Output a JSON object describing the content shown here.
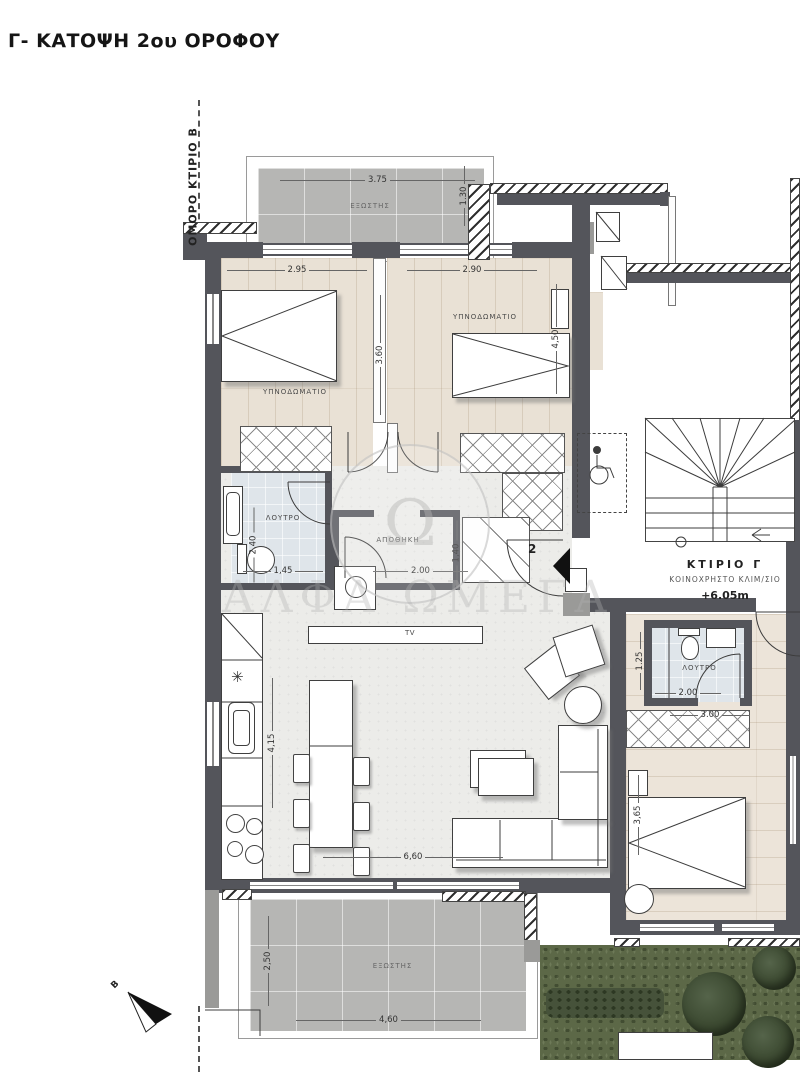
{
  "title": "Γ- ΚΑΤΟΨΗ 2ου ΟΡΟΦΟΥ",
  "neighbor_label": "ΟΜΟΡΟ ΚΤΙΡΙΟ Β",
  "north_label": "Β",
  "watermark": {
    "text": "ΑΛΦΑ ΩΜΕΓΑ",
    "monogram": "Ω"
  },
  "entry": {
    "door_number": "2"
  },
  "stairwell": {
    "building": "ΚΤΙΡΙΟ  Γ",
    "use": "ΚΟΙΝΟΧΡΗΣΤΟ ΚΛΙΜ/ΣΙΟ",
    "level": "+6.05m"
  },
  "rooms": {
    "balcony_top": {
      "label": "ΕΞΩΣΤΗΣ",
      "width": "3.75",
      "depth": "1.30"
    },
    "bedroom1": {
      "label": "ΥΠΝΟΔΩΜΑΤΙΟ",
      "width": "2.95",
      "depth": "3.60"
    },
    "bedroom2": {
      "label": "ΥΠΝΟΔΩΜΑΤΙΟ",
      "width": "2.90",
      "depth": "4,50"
    },
    "bathroom1": {
      "label": "ΛΟΥΤΡΟ",
      "width": "1,45",
      "depth": "2.40"
    },
    "storage": {
      "label": "ΑΠΟΘΗΚΗ",
      "width": "2.00",
      "closet_depth": "1,40"
    },
    "living": {
      "tv_label": "TV",
      "width": "6,60",
      "depth": "4,15"
    },
    "bathroom2": {
      "label": "ΛΟΥΤΡΟ",
      "width": "2.00",
      "depth": "1.25",
      "wardrobe_width": "3.00"
    },
    "bedroom3": {
      "depth": "3,65"
    },
    "balcony_bottom": {
      "label": "ΕΞΩΣΤΗΣ",
      "width": "4,60",
      "depth": "2,50"
    }
  }
}
